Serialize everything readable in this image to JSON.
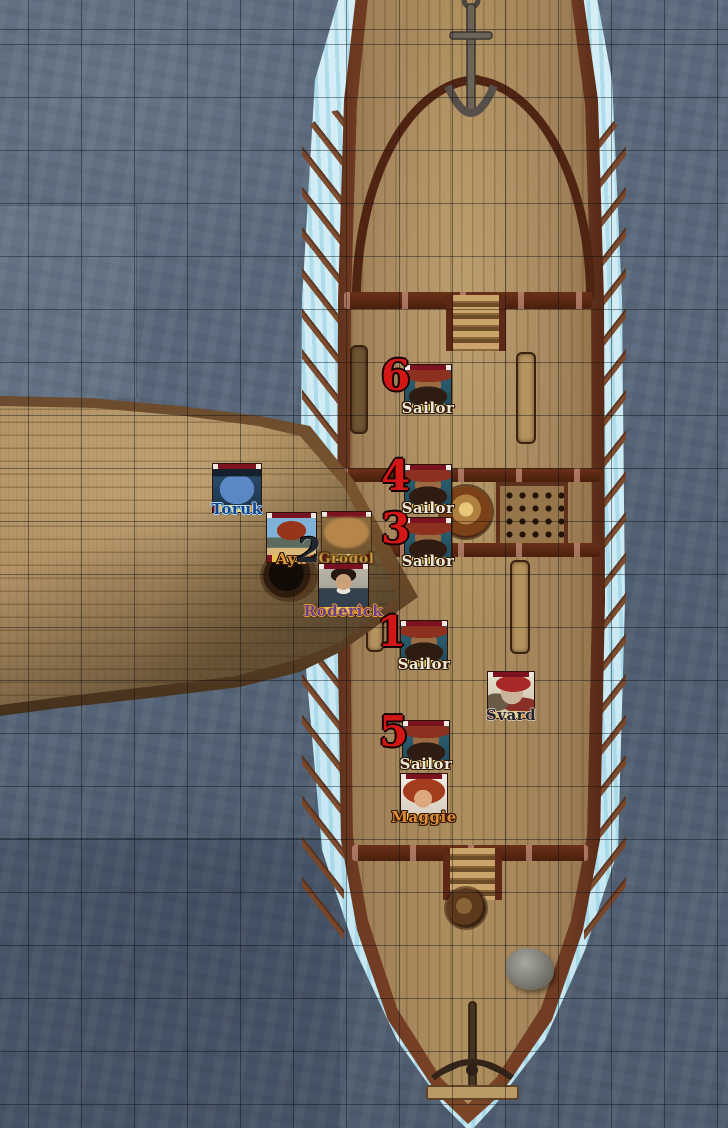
{
  "scene": {
    "type": "virtual-tabletop-battle-map",
    "description": "Top-down naval boarding encounter: a small sailboat rammed bow-first into the port side of a large oared galley on open water",
    "grid_cell_px": 53,
    "colors": {
      "water": "#5d6d7e",
      "wake_foam": "#cde9f3",
      "hull_rail": "#6e3a22",
      "galley_deck": "#a3835a",
      "sailboat_deck": "#a98c5e",
      "initiative_number_red": "#d31616",
      "token_health_bar": "#7a1220",
      "token_label_gold_band": "#f0d878"
    },
    "objects": [
      "anchor",
      "bow-railing",
      "fore-ladder",
      "rowing-benches",
      "capstan",
      "cargo-grate",
      "aft-ladder",
      "aft-capstan",
      "deck-rock",
      "ballista",
      "oars",
      "mast-hole"
    ]
  },
  "tokens": [
    {
      "id": "sailor-6",
      "label": "Sailor",
      "number": "6"
    },
    {
      "id": "sailor-4",
      "label": "Sailor",
      "number": "4"
    },
    {
      "id": "sailor-3",
      "label": "Sailor",
      "number": "3"
    },
    {
      "id": "sailor-1",
      "label": "Sailor",
      "number": "1"
    },
    {
      "id": "svard",
      "label": "Svard"
    },
    {
      "id": "sailor-5",
      "label": "Sailor",
      "number": "5"
    },
    {
      "id": "maggie",
      "label": "Maggie"
    },
    {
      "id": "toruk",
      "label": "Toruk"
    },
    {
      "id": "aya",
      "label": "Aya"
    },
    {
      "id": "grogol",
      "label": "Grogol"
    },
    {
      "id": "roderick",
      "label": "Roderick"
    }
  ],
  "markers": [
    {
      "glyph": "2"
    }
  ]
}
